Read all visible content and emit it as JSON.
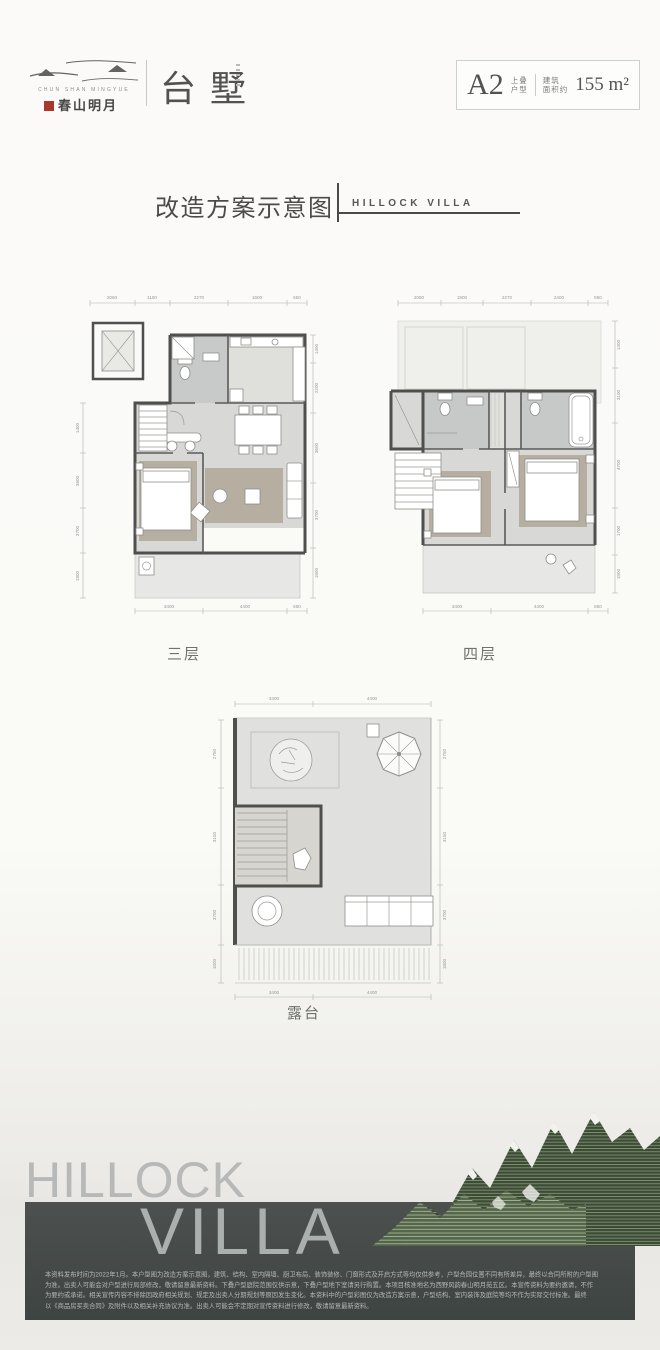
{
  "logo": {
    "en": "CHUN SHAN MINGYUE",
    "cn": "春山明月",
    "product": "台墅"
  },
  "badge": {
    "unit": "A2",
    "type1": "上叠",
    "type2": "户型",
    "area1": "建筑",
    "area2": "面积约",
    "area": "155 m²"
  },
  "title": {
    "cn": "改造方案示意图",
    "en": "HILLOCK VILLA"
  },
  "plans": {
    "floor3": {
      "label": "三层",
      "dims_top": [
        "2060",
        "1150",
        "2270",
        "1600",
        "650"
      ],
      "dims_bottom": [
        "3400",
        "4400",
        "650"
      ],
      "dims_left": [
        "1400",
        "3600",
        "3700",
        "1800"
      ],
      "dims_right": [
        "1400",
        "2200",
        "3600",
        "3700",
        "1800"
      ]
    },
    "floor4": {
      "label": "四层",
      "dims_top": [
        "2060",
        "1900",
        "2270",
        "2400",
        "650"
      ],
      "dims_bottom": [
        "3400",
        "4400",
        "650"
      ],
      "dims_right": [
        "1400",
        "3100",
        "4700",
        "1700",
        "1800"
      ]
    },
    "terrace": {
      "label": "露台",
      "dims_top": [
        "3400",
        "4400"
      ],
      "dims_bottom": [
        "3400",
        "4400"
      ],
      "dims_left": [
        "2750",
        "3150",
        "3700",
        "1800"
      ],
      "dims_right": [
        "2750",
        "3150",
        "3700",
        "1800"
      ]
    }
  },
  "footer": {
    "wordmark1": "HILLOCK",
    "wordmark2": "VILLA",
    "disclaimer_lines": [
      "本资料发布时间为2022年1月。本户型图为改造方案示意图，建筑、结构、室内隔墙、厨卫布局、装饰装修、门窗形式及开启方式等均仅供参考，户型合园位置不同有所差异，最终以合同所附的户型图",
      "为准。出卖人可能会对户型进行局部修改，敬请留意最新资料。下叠户型庭院范围仅供示意，下叠户型地下室请另行购置。本项目核准地名为西野风韵春山明月苑五区。本宣传资料为要约邀请，不作",
      "为要约或承诺。相关宣传内容不排除因政府相关规划、规定及出卖人分期规划等原因发生变化。本资料中的户型彩图仅为改造方案示意，户型结构、室内装饰及庭院等均不作为实际交付标准。最终",
      "以《商品房买卖合同》及附件以及相关补充协议为准。出卖人可能会不定期对宣传资料进行修改，敬请留意最新资料。"
    ]
  },
  "colors": {
    "band": "#454b49",
    "wall": "#4f4f4d",
    "floor": "#d8d9d6",
    "rug": "#b6aea1",
    "mountain": "#3c4c36",
    "seal_red": "#a8372e"
  }
}
